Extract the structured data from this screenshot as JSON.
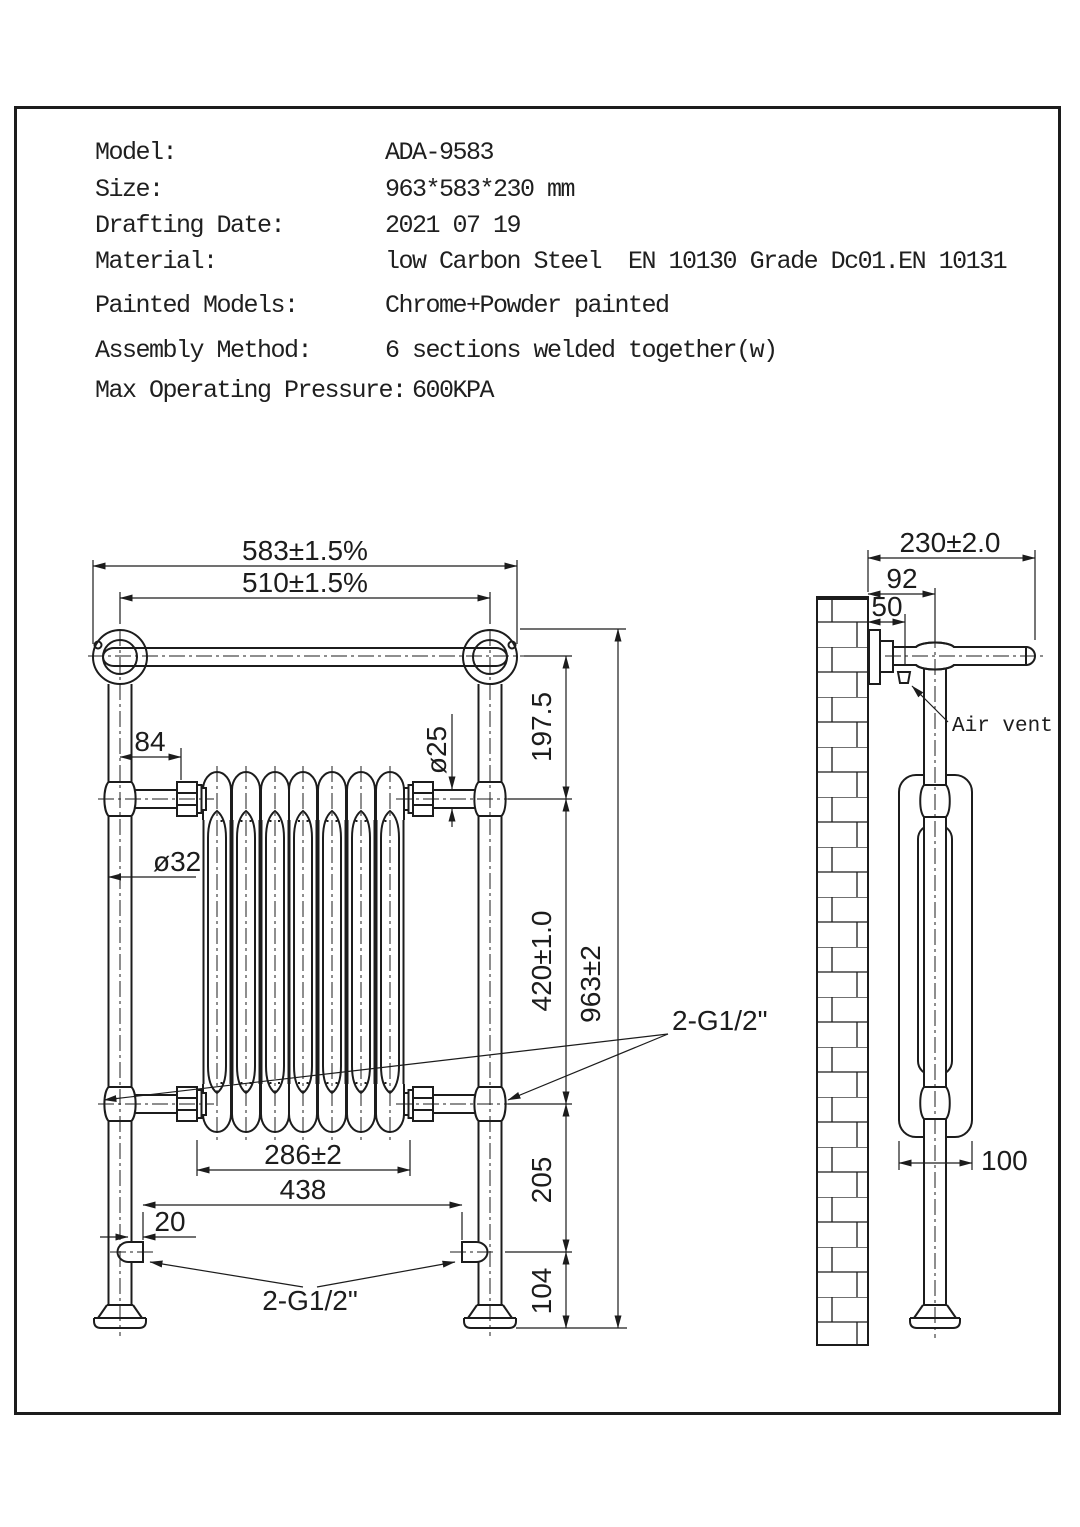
{
  "header": {
    "rows": [
      {
        "label": "Model:",
        "value": "ADA-9583"
      },
      {
        "label": "Size:",
        "value": "963*583*230 mm"
      },
      {
        "label": "Drafting Date:",
        "value": "2021 07 19"
      },
      {
        "label": "Material:",
        "value": "low Carbon Steel  EN 10130 Grade Dc01.EN 10131"
      },
      {
        "label": "Painted Models:",
        "value": "Chrome+Powder painted"
      },
      {
        "label": "Assembly Method:",
        "value": "6 sections welded together(w)"
      },
      {
        "label": "Max Operating Pressure:",
        "value": "600KPA"
      }
    ]
  },
  "front_view": {
    "dims": {
      "overall_width": "583±1.5%",
      "bar_centers_width": "510±1.5%",
      "post_to_radiator": "84",
      "post_diameter": "ø32",
      "connector_diameter": "ø25",
      "bar_to_connector_height": "197.5",
      "connector_span_height": "420±1.0",
      "overall_height": "963±2",
      "radiator_width": "286±2",
      "inlet_span": "438",
      "inlet_offset": "20",
      "mid_connection": "2-G1/2\"",
      "bottom_connection": "2-G1/2\"",
      "connector_to_inlet": "205",
      "inlet_to_floor": "104"
    }
  },
  "side_view": {
    "dims": {
      "overall_depth": "230±2.0",
      "wall_to_post": "92",
      "wall_to_vent": "50",
      "radiator_depth": "100"
    },
    "labels": {
      "air_vent": "Air vent"
    }
  },
  "colors": {
    "line": "#1c1c1c",
    "background": "#ffffff"
  }
}
